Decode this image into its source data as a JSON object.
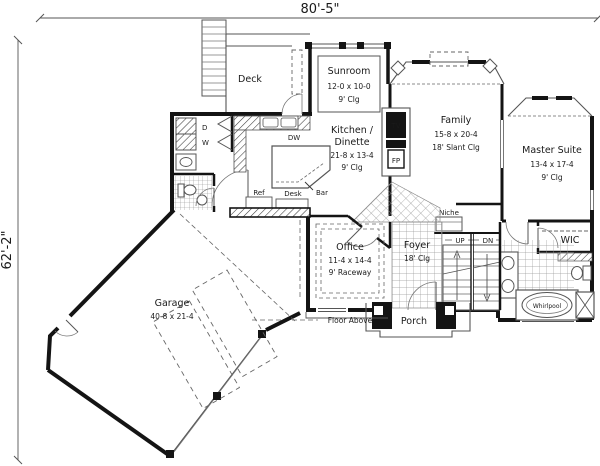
{
  "dimensions": {
    "width": "80'-5\"",
    "height": "62'-2\""
  },
  "rooms": {
    "deck": {
      "name": "Deck"
    },
    "sunroom": {
      "name": "Sunroom",
      "size": "12-0 x 10-0",
      "ceiling": "9' Clg"
    },
    "kitchen": {
      "name_line1": "Kitchen /",
      "name_line2": "Dinette",
      "size": "21-8 x 13-4",
      "ceiling": "9' Clg"
    },
    "family": {
      "name": "Family",
      "size": "15-8 x 20-4",
      "ceiling": "18' Slant Clg"
    },
    "master": {
      "name": "Master Suite",
      "size": "13-4 x 17-4",
      "ceiling": "9' Clg"
    },
    "office": {
      "name": "Office",
      "size": "11-4 x 14-4",
      "ceiling": "9' Raceway"
    },
    "foyer": {
      "name": "Foyer",
      "ceiling": "18' Clg"
    },
    "garage": {
      "name": "Garage",
      "size": "40-8 x 21-4"
    },
    "porch": {
      "name": "Porch"
    },
    "wic": {
      "name": "WIC"
    }
  },
  "fixtures": {
    "dw": "DW",
    "bar": "Bar",
    "ref": "Ref",
    "desk": "Desk",
    "tv": "TV",
    "fp": "FP",
    "dryer": "D",
    "washer": "W",
    "niche": "Niche",
    "up": "UP",
    "dn": "DN",
    "whirlpool": "Whirlpool",
    "floor_above": "Floor Above"
  },
  "colors": {
    "wall": "#141414",
    "thin_line": "#555555",
    "tile_line": "#999999",
    "background": "#ffffff"
  }
}
